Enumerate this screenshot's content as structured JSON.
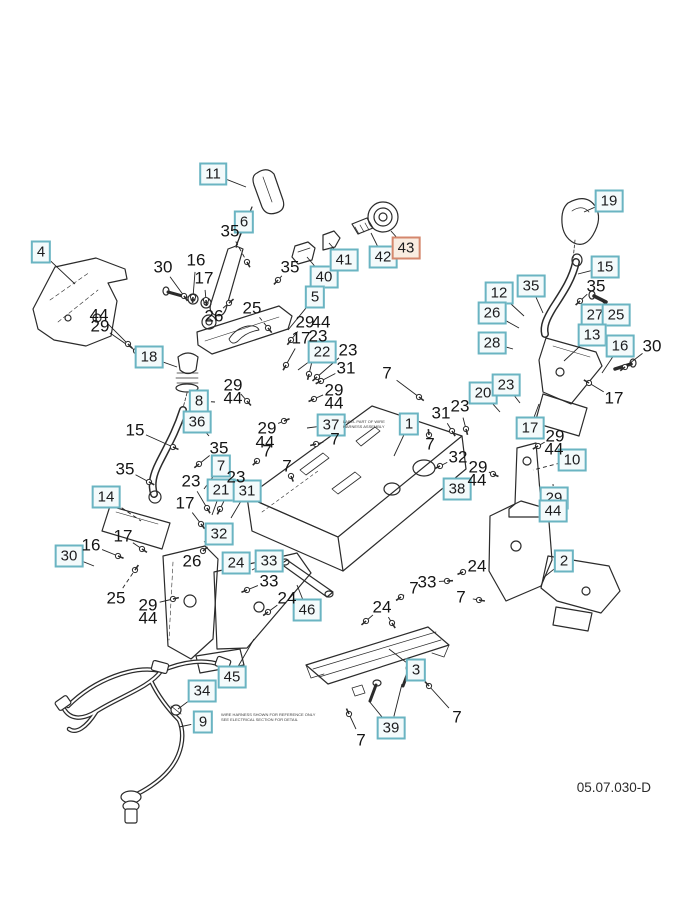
{
  "diagram": {
    "footer_code": "05.07.030-D",
    "colors": {
      "callout_border": "#6ab4c2",
      "callout_fill": "#f3fafb",
      "highlight_border": "#d4876d",
      "highlight_fill": "#f9ece1",
      "line_art": "#2b2b2b",
      "text": "#1c1c1e"
    },
    "highlighted_callout": "43"
  },
  "callouts": [
    {
      "n": "11",
      "x": 213,
      "y": 174,
      "s": "box",
      "t": [
        246,
        187
      ]
    },
    {
      "n": "4",
      "x": 41,
      "y": 252,
      "s": "box",
      "t": [
        75,
        284
      ]
    },
    {
      "n": "6",
      "x": 244,
      "y": 222,
      "s": "box",
      "t": [
        236,
        248
      ]
    },
    {
      "n": "19",
      "x": 609,
      "y": 201,
      "s": "box",
      "t": [
        584,
        212
      ]
    },
    {
      "n": "15",
      "x": 605,
      "y": 267,
      "s": "box",
      "t": [
        578,
        274
      ]
    },
    {
      "n": "35",
      "x": 531,
      "y": 286,
      "s": "box",
      "t": [
        543,
        313
      ]
    },
    {
      "n": "12",
      "x": 499,
      "y": 293,
      "s": "box",
      "t": [
        524,
        316
      ]
    },
    {
      "n": "26",
      "x": 492,
      "y": 313,
      "s": "box",
      "t": [
        519,
        328
      ]
    },
    {
      "n": "27",
      "x": 595,
      "y": 315,
      "s": "box",
      "t": [
        578,
        326
      ]
    },
    {
      "n": "25",
      "x": 616,
      "y": 315,
      "s": "box",
      "t": [
        602,
        301
      ]
    },
    {
      "n": "13",
      "x": 592,
      "y": 335,
      "s": "box",
      "t": [
        564,
        361
      ]
    },
    {
      "n": "16",
      "x": 620,
      "y": 346,
      "s": "box",
      "t": [
        602,
        373
      ]
    },
    {
      "n": "28",
      "x": 492,
      "y": 343,
      "s": "box",
      "t": [
        513,
        349
      ]
    },
    {
      "n": "40",
      "x": 324,
      "y": 277,
      "s": "box",
      "t": [
        307,
        257
      ]
    },
    {
      "n": "41",
      "x": 344,
      "y": 260,
      "s": "box",
      "t": [
        329,
        243
      ]
    },
    {
      "n": "42",
      "x": 383,
      "y": 257,
      "s": "box",
      "t": [
        371,
        233
      ]
    },
    {
      "n": "43",
      "x": 406,
      "y": 248,
      "s": "hl",
      "t": [
        391,
        231
      ]
    },
    {
      "n": "5",
      "x": 315,
      "y": 297,
      "s": "box",
      "t": [
        288,
        330
      ]
    },
    {
      "n": "18",
      "x": 149,
      "y": 357,
      "s": "box",
      "t": [
        177,
        367
      ]
    },
    {
      "n": "8",
      "x": 199,
      "y": 401,
      "s": "box",
      "t": [
        215,
        402
      ]
    },
    {
      "n": "36",
      "x": 197,
      "y": 422,
      "s": "box",
      "t": [
        209,
        436
      ]
    },
    {
      "n": "22",
      "x": 322,
      "y": 352,
      "s": "box",
      "t": [
        298,
        370
      ]
    },
    {
      "n": "37",
      "x": 331,
      "y": 425,
      "s": "box",
      "t": [
        307,
        428
      ]
    },
    {
      "n": "20",
      "x": 483,
      "y": 393,
      "s": "box",
      "t": [
        500,
        412
      ]
    },
    {
      "n": "23",
      "x": 506,
      "y": 385,
      "s": "box",
      "t": [
        520,
        403
      ]
    },
    {
      "n": "17",
      "x": 530,
      "y": 428,
      "s": "box",
      "t": [
        539,
        404
      ]
    },
    {
      "n": "10",
      "x": 572,
      "y": 460,
      "s": "box",
      "t": [
        533,
        470
      ],
      "d": 1
    },
    {
      "n": "1",
      "x": 409,
      "y": 424,
      "s": "box",
      "t": [
        394,
        456
      ]
    },
    {
      "n": "7",
      "x": 221,
      "y": 466,
      "s": "box",
      "t": [
        204,
        489
      ]
    },
    {
      "n": "21",
      "x": 221,
      "y": 490,
      "s": "box",
      "t": [
        212,
        515
      ]
    },
    {
      "n": "31",
      "x": 247,
      "y": 491,
      "s": "box",
      "t": [
        231,
        518
      ]
    },
    {
      "n": "32",
      "x": 219,
      "y": 534,
      "s": "box",
      "t": [
        204,
        542
      ]
    },
    {
      "n": "14",
      "x": 106,
      "y": 497,
      "s": "box",
      "t": [
        141,
        521
      ],
      "d": 1
    },
    {
      "n": "30",
      "x": 69,
      "y": 556,
      "s": "box",
      "t": [
        94,
        566
      ]
    },
    {
      "n": "24",
      "x": 236,
      "y": 563,
      "s": "box",
      "t": [
        247,
        571
      ]
    },
    {
      "n": "33",
      "x": 269,
      "y": 561,
      "s": "box",
      "t": [
        252,
        570
      ]
    },
    {
      "n": "29",
      "x": 554,
      "y": 498,
      "s": "box",
      "t": [
        553,
        484
      ]
    },
    {
      "n": "44",
      "x": 553,
      "y": 511,
      "s": "box"
    },
    {
      "n": "38",
      "x": 457,
      "y": 489,
      "s": "box",
      "t": [
        472,
        477
      ]
    },
    {
      "n": "2",
      "x": 564,
      "y": 561,
      "s": "box",
      "t": [
        543,
        578
      ]
    },
    {
      "n": "46",
      "x": 307,
      "y": 610,
      "s": "box",
      "t": [
        297,
        585
      ]
    },
    {
      "n": "45",
      "x": 232,
      "y": 677,
      "s": "box",
      "t": [
        254,
        639
      ]
    },
    {
      "n": "34",
      "x": 202,
      "y": 691,
      "s": "box",
      "t": [
        178,
        709
      ]
    },
    {
      "n": "9",
      "x": 203,
      "y": 722,
      "s": "box",
      "t": [
        179,
        727
      ]
    },
    {
      "n": "3",
      "x": 416,
      "y": 670,
      "s": "box",
      "t": [
        389,
        649
      ]
    },
    {
      "n": "39",
      "x": 391,
      "y": 728,
      "s": "box",
      "t": [
        369,
        701
      ],
      "t2": [
        402,
        684
      ]
    },
    {
      "n": "30",
      "x": 163,
      "y": 267,
      "s": "txt",
      "t": [
        184,
        296
      ]
    },
    {
      "n": "16",
      "x": 196,
      "y": 260,
      "s": "txt",
      "t": [
        193,
        297
      ]
    },
    {
      "n": "17",
      "x": 204,
      "y": 278,
      "s": "txt",
      "t": [
        206,
        300
      ]
    },
    {
      "n": "26",
      "x": 214,
      "y": 316,
      "s": "txt",
      "t": [
        229,
        303
      ]
    },
    {
      "n": "44",
      "x": 99,
      "y": 315,
      "s": "txt",
      "t": [
        128,
        344
      ]
    },
    {
      "n": "29",
      "x": 100,
      "y": 326,
      "s": "txt",
      "t": [
        136,
        351
      ]
    },
    {
      "n": "35",
      "x": 230,
      "y": 231,
      "s": "txt",
      "t": [
        247,
        262
      ],
      "d": 1
    },
    {
      "n": "35",
      "x": 290,
      "y": 267,
      "s": "txt",
      "t": [
        278,
        280
      ],
      "d": 1
    },
    {
      "n": "25",
      "x": 252,
      "y": 308,
      "s": "txt",
      "t": [
        268,
        328
      ],
      "d": 1
    },
    {
      "n": "29",
      "x": 305,
      "y": 322,
      "s": "txt",
      "t": [
        291,
        340
      ]
    },
    {
      "n": "44",
      "x": 321,
      "y": 322,
      "s": "txt"
    },
    {
      "n": "17",
      "x": 301,
      "y": 338,
      "s": "txt",
      "t": [
        286,
        365
      ]
    },
    {
      "n": "23",
      "x": 318,
      "y": 336,
      "s": "txt",
      "t": [
        309,
        374
      ]
    },
    {
      "n": "23",
      "x": 348,
      "y": 350,
      "s": "txt",
      "t": [
        317,
        377
      ]
    },
    {
      "n": "31",
      "x": 346,
      "y": 368,
      "s": "txt",
      "t": [
        321,
        381
      ]
    },
    {
      "n": "7",
      "x": 387,
      "y": 373,
      "s": "txt",
      "t": [
        419,
        397
      ]
    },
    {
      "n": "29",
      "x": 334,
      "y": 390,
      "s": "txt",
      "t": [
        314,
        399
      ]
    },
    {
      "n": "44",
      "x": 334,
      "y": 403,
      "s": "txt"
    },
    {
      "n": "29",
      "x": 233,
      "y": 385,
      "s": "txt",
      "t": [
        247,
        401
      ]
    },
    {
      "n": "44",
      "x": 233,
      "y": 398,
      "s": "txt"
    },
    {
      "n": "15",
      "x": 135,
      "y": 430,
      "s": "txt",
      "t": [
        173,
        447
      ]
    },
    {
      "n": "35",
      "x": 219,
      "y": 448,
      "s": "txt",
      "t": [
        199,
        464
      ]
    },
    {
      "n": "35",
      "x": 125,
      "y": 469,
      "s": "txt",
      "t": [
        149,
        482
      ]
    },
    {
      "n": "23",
      "x": 191,
      "y": 481,
      "s": "txt",
      "t": [
        207,
        508
      ]
    },
    {
      "n": "23",
      "x": 236,
      "y": 477,
      "s": "txt",
      "t": [
        220,
        509
      ]
    },
    {
      "n": "17",
      "x": 185,
      "y": 503,
      "s": "txt",
      "t": [
        201,
        524
      ]
    },
    {
      "n": "29",
      "x": 267,
      "y": 428,
      "s": "txt",
      "t": [
        284,
        421
      ]
    },
    {
      "n": "44",
      "x": 265,
      "y": 442,
      "s": "txt"
    },
    {
      "n": "7",
      "x": 267,
      "y": 451,
      "s": "txt",
      "t": [
        257,
        461
      ]
    },
    {
      "n": "7",
      "x": 335,
      "y": 439,
      "s": "txt",
      "t": [
        316,
        444
      ]
    },
    {
      "n": "7",
      "x": 287,
      "y": 466,
      "s": "txt",
      "t": [
        291,
        476
      ]
    },
    {
      "n": "31",
      "x": 441,
      "y": 413,
      "s": "txt",
      "t": [
        452,
        431
      ]
    },
    {
      "n": "23",
      "x": 460,
      "y": 406,
      "s": "txt",
      "t": [
        466,
        429
      ]
    },
    {
      "n": "7",
      "x": 430,
      "y": 444,
      "s": "txt",
      "t": [
        429,
        435
      ]
    },
    {
      "n": "32",
      "x": 458,
      "y": 457,
      "s": "txt",
      "t": [
        440,
        466
      ]
    },
    {
      "n": "29",
      "x": 478,
      "y": 467,
      "s": "txt",
      "t": [
        493,
        474
      ]
    },
    {
      "n": "44",
      "x": 477,
      "y": 480,
      "s": "txt"
    },
    {
      "n": "17",
      "x": 614,
      "y": 398,
      "s": "txt",
      "t": [
        589,
        383
      ]
    },
    {
      "n": "30",
      "x": 652,
      "y": 346,
      "s": "txt",
      "t": [
        625,
        367
      ]
    },
    {
      "n": "35",
      "x": 596,
      "y": 286,
      "s": "txt",
      "t": [
        580,
        301
      ]
    },
    {
      "n": "29",
      "x": 555,
      "y": 436,
      "s": "txt",
      "t": [
        538,
        446
      ]
    },
    {
      "n": "44",
      "x": 554,
      "y": 449,
      "s": "txt"
    },
    {
      "n": "24",
      "x": 477,
      "y": 566,
      "s": "txt",
      "t": [
        463,
        572
      ]
    },
    {
      "n": "33",
      "x": 427,
      "y": 582,
      "s": "txt",
      "t": [
        447,
        581
      ]
    },
    {
      "n": "7",
      "x": 414,
      "y": 588,
      "s": "txt",
      "t": [
        401,
        597
      ]
    },
    {
      "n": "7",
      "x": 461,
      "y": 597,
      "s": "txt",
      "t": [
        479,
        600
      ]
    },
    {
      "n": "33",
      "x": 269,
      "y": 581,
      "s": "txt",
      "t": [
        247,
        590
      ]
    },
    {
      "n": "24",
      "x": 287,
      "y": 598,
      "s": "txt",
      "t": [
        268,
        612
      ]
    },
    {
      "n": "16",
      "x": 91,
      "y": 545,
      "s": "txt",
      "t": [
        118,
        556
      ]
    },
    {
      "n": "17",
      "x": 123,
      "y": 536,
      "s": "txt",
      "t": [
        142,
        549
      ]
    },
    {
      "n": "25",
      "x": 116,
      "y": 598,
      "s": "txt",
      "t": [
        135,
        570
      ],
      "d": 1
    },
    {
      "n": "26",
      "x": 192,
      "y": 561,
      "s": "txt",
      "t": [
        203,
        551
      ]
    },
    {
      "n": "29",
      "x": 148,
      "y": 605,
      "s": "txt",
      "t": [
        173,
        599
      ]
    },
    {
      "n": "44",
      "x": 148,
      "y": 618,
      "s": "txt"
    },
    {
      "n": "24",
      "x": 382,
      "y": 607,
      "s": "txt",
      "t": [
        366,
        621
      ],
      "t2": [
        392,
        623
      ]
    },
    {
      "n": "7",
      "x": 457,
      "y": 717,
      "s": "txt",
      "t": [
        429,
        686
      ]
    },
    {
      "n": "7",
      "x": 361,
      "y": 740,
      "s": "txt",
      "t": [
        349,
        714
      ]
    }
  ],
  "fine_print": [
    {
      "x": 343,
      "y": 419,
      "lines": [
        "LABEL PART OF WIRE",
        "HARNESS ASSEMBLY"
      ]
    },
    {
      "x": 221,
      "y": 712,
      "lines": [
        "WIRE HARNESS SHOWN FOR REFERENCE ONLY",
        "SEE ELECTRICAL SECTION FOR DETAIL"
      ]
    }
  ]
}
